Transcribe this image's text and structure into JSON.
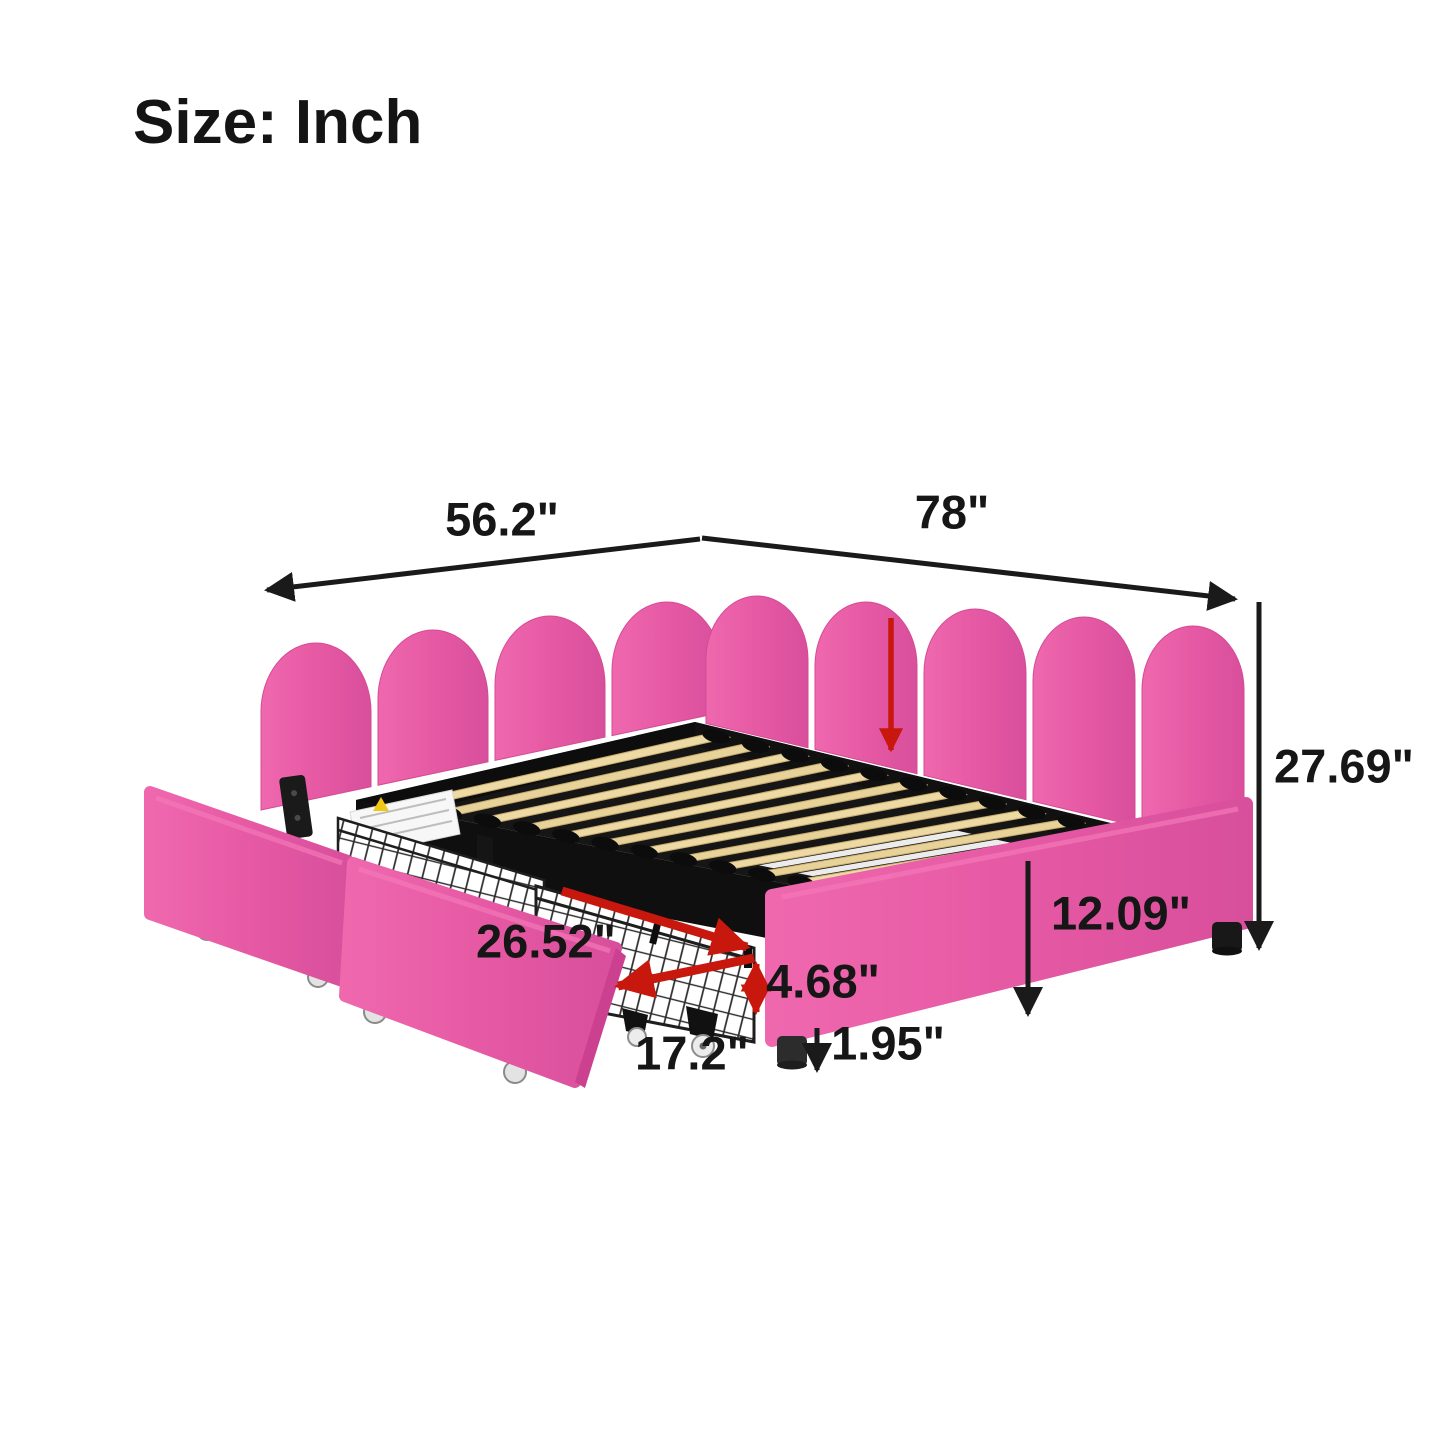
{
  "title": "Size: Inch",
  "dimensions": {
    "headboard_width": "56.2\"",
    "bed_length": "78\"",
    "total_height": "27.69\"",
    "side_rail_height": "12.09\"",
    "drawer_length": "26.52\"",
    "drawer_height": "4.68\"",
    "drawer_width": "17.2\"",
    "leg_height": "1.95\""
  },
  "colors": {
    "upholstery_pink": "#e85da7",
    "upholstery_pink_dark": "#d84f9c",
    "annotation_red": "#c8170d",
    "dimension_black": "#1a1a1a",
    "slat_wood": "#ead7a2",
    "frame_black": "#141414"
  }
}
